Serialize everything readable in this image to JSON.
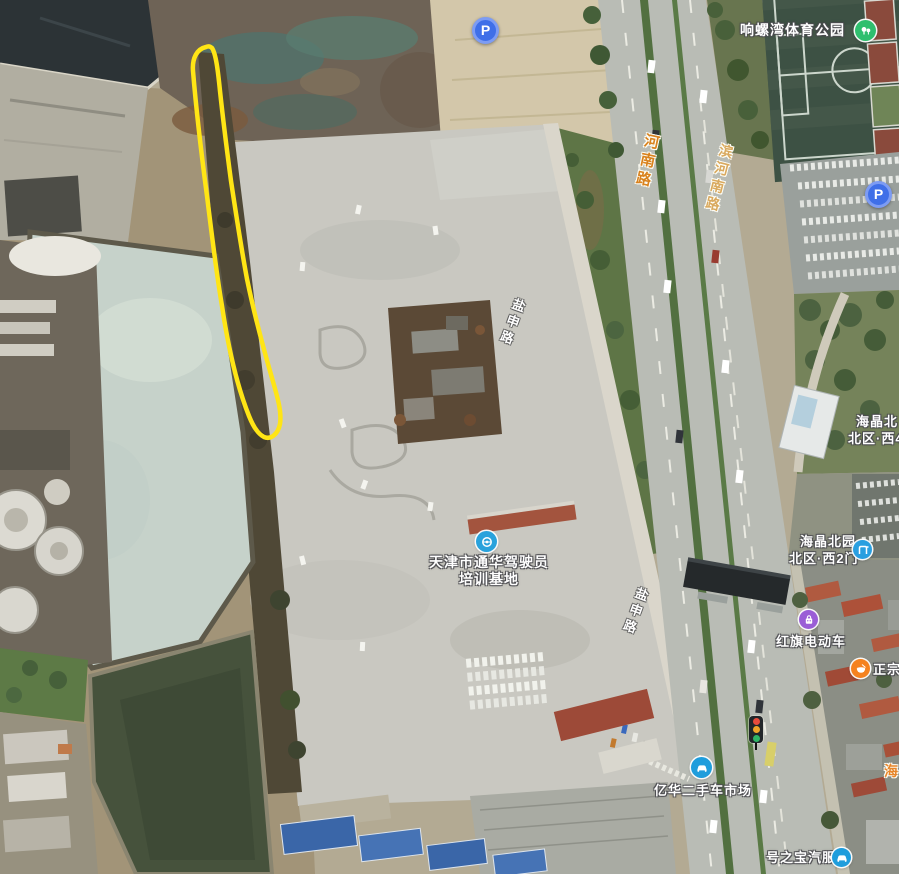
{
  "map": {
    "view_type": "satellite",
    "annotation_outline_color": "#ffe515"
  },
  "road_labels": {
    "henan": {
      "text": "河南路",
      "color": "#d9821e"
    },
    "binhenan": {
      "text": "滨河南路",
      "color": "#d9a95e"
    },
    "yanshen_north": {
      "text": "盐申路",
      "color": "#ffffff"
    },
    "yanshen_south": {
      "text": "盐申路",
      "color": "#ffffff"
    },
    "hai_partial": {
      "text": "海",
      "color": "#e8862a"
    }
  },
  "pois": {
    "sports_park": {
      "label": "响螺湾体育公园",
      "icon": "park-icon",
      "icon_color": "#2fbf6e"
    },
    "driving_school": {
      "label_line1": "天津市通华驾驶员",
      "label_line2": "培训基地",
      "icon": "driving-school-icon",
      "icon_color": "#29a2dc"
    },
    "haijing_west4": {
      "label_line1": "海晶北",
      "label_line2": "北区·西4"
    },
    "haijing_west2": {
      "label_line1": "海晶北园",
      "label_line2": "北区·西2门",
      "icon": "gate-icon",
      "icon_color": "#2a9fe0"
    },
    "hongqi_ebike": {
      "label": "红旗电动车",
      "icon": "shop-bag-icon",
      "icon_color": "#9a5ed6"
    },
    "zhengzong": {
      "label": "正宗",
      "icon": "food-icon",
      "icon_color": "#f5821f"
    },
    "yihua_used_car": {
      "label": "亿华二手车市场",
      "icon": "car-icon",
      "icon_color": "#1f9ddc"
    },
    "haozhibao_auto": {
      "label": "号之宝汽服",
      "icon": "car-icon",
      "icon_color": "#1f9ddc"
    }
  },
  "markers": {
    "parking_letter": "P",
    "parking_pin_color": "#3f6fe8",
    "traffic_light": "traffic-light"
  }
}
